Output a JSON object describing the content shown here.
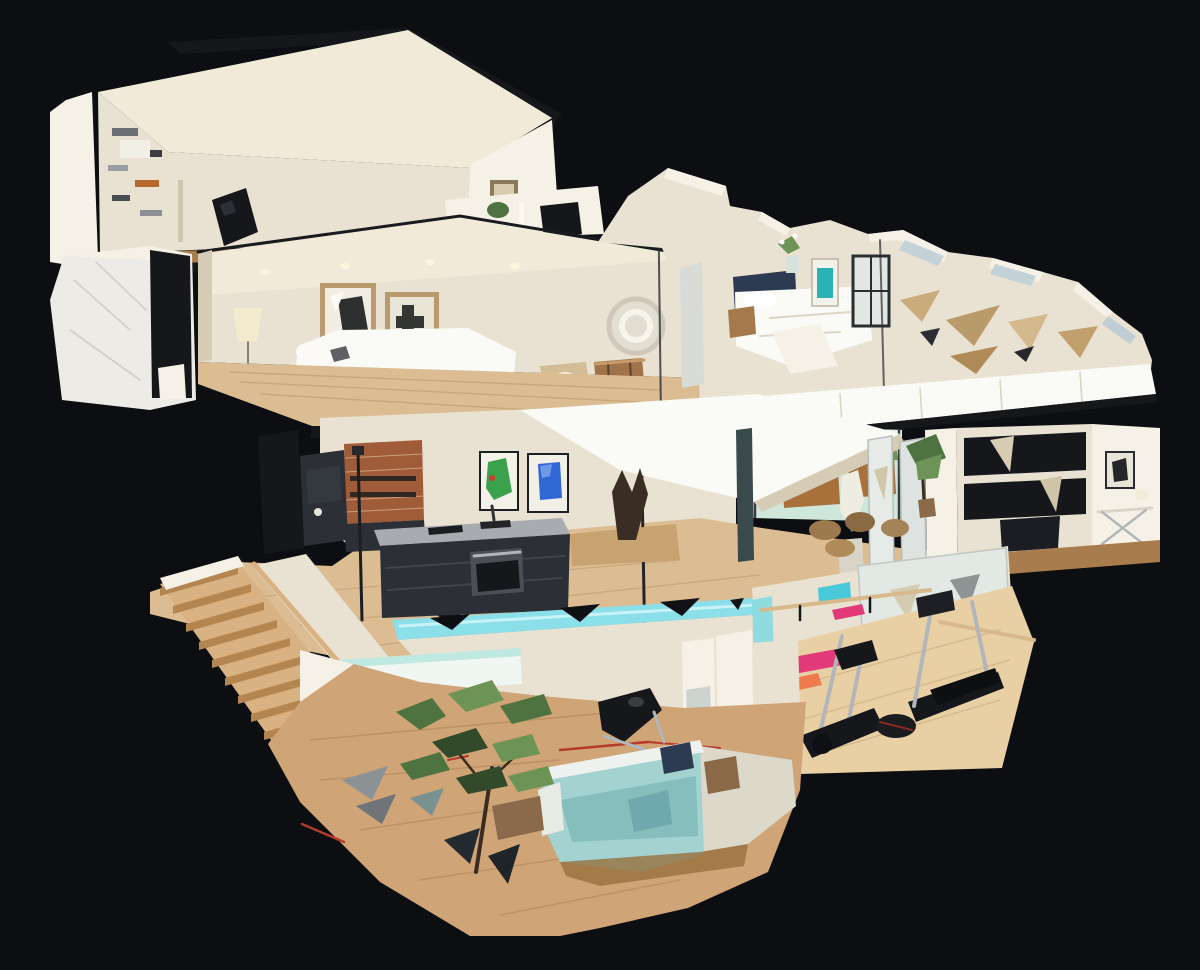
{
  "view": {
    "name": "3d-dollhouse-cutaway-view",
    "description_hint": "photogrammetry dollhouse cutaway of a multi-level residence on black viewport"
  },
  "palette": {
    "bg": "#0d0e11",
    "wall": "#e9e1d1",
    "wall_bright": "#f6f1e6",
    "wall_shadow": "#d6cbb4",
    "ceiling": "#f1ead9",
    "white": "#fafaf6",
    "wood": "#dcbd93",
    "wood_deep": "#a97c4e",
    "wood_stair": "#d9b284",
    "wood_gym": "#e8d0a4",
    "wood_lower": "#cfa476",
    "dark": "#16171b",
    "dark2": "#2c2f36",
    "silver": "#b2b6bb",
    "glass": "#cfe6da",
    "teal_glass": "#8adfe9",
    "teal_sofa": "#a3d2d1",
    "art_green": "#3ba14d",
    "art_blue": "#3168d4",
    "art_teal": "#2ab3b4",
    "brick": "#a05c38",
    "plant": "#4e7340",
    "plant_light": "#6d9456",
    "plant_dark": "#32492a",
    "mat_pink": "#e23a79",
    "mat_orange": "#ef7a4b",
    "rug_red": "#b5392c",
    "beige": "#d3bd97",
    "marble": "#edebe6",
    "frame_tan": "#b89a6e",
    "counter": "#a8acb0",
    "navy": "#2c3a52",
    "brown": "#8a6848"
  },
  "scene": {
    "rooms": [
      "upper-study",
      "upper-living-room",
      "upper-bedroom-wing",
      "marble-bath",
      "kitchen-dining-level",
      "home-office",
      "terrace-window",
      "staircase",
      "gym",
      "lower-living-room"
    ]
  }
}
